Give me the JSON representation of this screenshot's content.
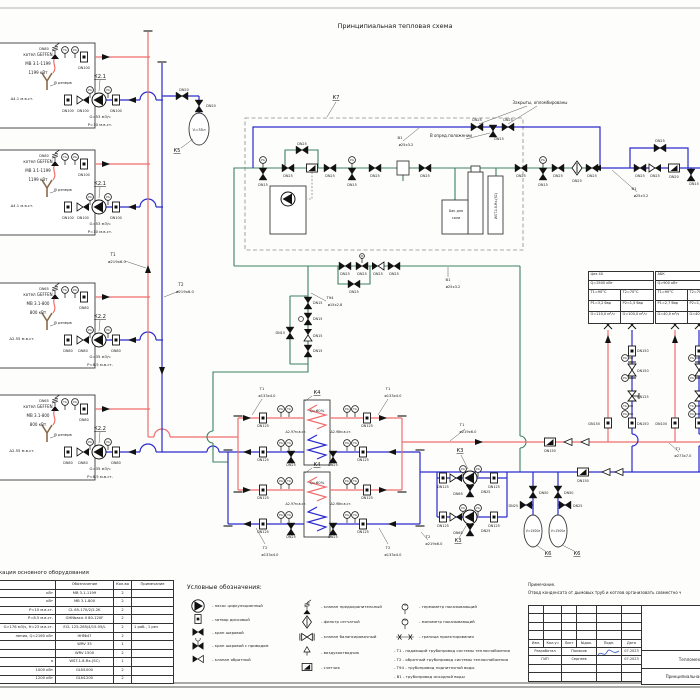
{
  "title": "Принципиальная тепловая схема",
  "colors": {
    "supply": "#ef6e6e",
    "return": "#2b2bcc",
    "raw_water": "#3c8162",
    "chimney": "#8a6a4a",
    "signature": "#3a55c0"
  },
  "gauges": {
    "tg": "TG",
    "pg": "PG"
  },
  "boilers": [
    {
      "y": 43,
      "name1": "котел GEFFEN",
      "name2": "МВ 3.1-1199",
      "name3": "1199 кВт",
      "delta": "Δ4.1 м.в.ст.",
      "reserve": "В резерв",
      "dn_safety": "DN80",
      "dn_supply": "DN100",
      "dn_return": "DN100",
      "pump": "К2.1",
      "flow": "G=53 м3/ч",
      "head": "P=10 м.в.ст."
    },
    {
      "y": 150,
      "name1": "котел GEFFEN",
      "name2": "МВ 3.1-1199",
      "name3": "1199 кВт",
      "delta": "Δ4.1 м.в.ст.",
      "reserve": "В резерв",
      "dn_safety": "DN80",
      "dn_supply": "DN100",
      "dn_return": "DN100",
      "pump": "К2.1",
      "flow": "G=53 м3/ч",
      "head": "P=10 м.в.ст."
    },
    {
      "y": 283,
      "name1": "котел GEFFEN",
      "name2": "МВ 3.1-800",
      "name3": "800 кВт",
      "delta": "Δ2.55 м.в.ст.",
      "reserve": "В резерв",
      "dn_safety": "DN65",
      "dn_supply": "DN80",
      "dn_return": "DN80",
      "pump": "К2.2",
      "flow": "G=35 м3/ч",
      "head": "P=8.5 м.в.ст."
    },
    {
      "y": 395,
      "name1": "котел GEFFEN",
      "name2": "МВ 3.1-800",
      "name3": "800 кВт",
      "delta": "Δ2.55 м.в.ст.",
      "reserve": "В резерв",
      "dn_safety": "DN65",
      "dn_supply": "DN80",
      "dn_return": "DN80",
      "pump": "К2.2",
      "flow": "G=35 м3/ч",
      "head": "P=8.5 м.в.ст."
    }
  ],
  "k4": [
    {
      "y": 400,
      "label": "К4",
      "q": "Q=60%",
      "dp_left": "Δ2.97м.в.ст.",
      "dp_right": "Δ2.98м.в.ст.",
      "dn_main": "DN125",
      "dn_drain": "DN25"
    },
    {
      "y": 472,
      "label": "К4",
      "q": "Q=60%",
      "dp_left": "Δ2.97м.в.ст.",
      "dp_right": "Δ2.98м.в.ст.",
      "dn_main": "DN125",
      "dn_drain": "DN25"
    }
  ],
  "consumers": [
    {
      "name": "Цех 40",
      "q": "Q=2500 кВт",
      "t1": "Т1=90°С",
      "t2": "Т2=70°С",
      "p1": "Р1=3,2 бар",
      "p2": "Р2=1,5 бар",
      "g1": "G=110,0 м³/ч",
      "g2": "G=100,0 м³/ч"
    },
    {
      "name": "АБК",
      "q": "Q=900 кВт",
      "t1": "Т1=90°С",
      "t2": "Т2=70°С",
      "p1": "Р1=2,7 бар",
      "p2": "Р2=1,5 бар",
      "g1": "G=40,0 м³/ч",
      "g2": "G=40,0 м³/ч"
    }
  ],
  "schematic": {
    "labels": [
      [
        113,
        256,
        "Т1",
        4
      ],
      [
        117,
        263,
        "ø219х6.0",
        3.8
      ],
      [
        181,
        286,
        "Т2",
        4
      ],
      [
        185,
        293,
        "ø219х6.0",
        3.8
      ],
      [
        184,
        91,
        "DN20",
        3.4
      ],
      [
        211,
        107,
        "DN20",
        3.4
      ],
      [
        199,
        131,
        "V=35л",
        3.8
      ],
      [
        177,
        152,
        "К5",
        5.2
      ],
      [
        336,
        99,
        "К7",
        5.2
      ],
      [
        263,
        161,
        "PG",
        2.7
      ],
      [
        263,
        186,
        "DN15",
        3.4
      ],
      [
        288,
        177,
        "DN25",
        3.4
      ],
      [
        302,
        145,
        "DN25",
        3.4
      ],
      [
        330,
        177,
        "DN25",
        3.4
      ],
      [
        352,
        161,
        "PG",
        2.7
      ],
      [
        352,
        186,
        "DN15",
        3.4
      ],
      [
        375,
        177,
        "DN25",
        3.4
      ],
      [
        425,
        177,
        "DN25",
        3.4
      ],
      [
        521,
        177,
        "DN25",
        3.4
      ],
      [
        543,
        161,
        "PG",
        2.7
      ],
      [
        543,
        186,
        "DN15",
        3.4
      ],
      [
        558,
        177,
        "DN25",
        3.4
      ],
      [
        577,
        182,
        "DN25",
        3.4
      ],
      [
        592,
        177,
        "DN25",
        3.4
      ],
      [
        456,
        212,
        "Бак для",
        3.4
      ],
      [
        456,
        219,
        "соли",
        3.4
      ],
      [
        497,
        206,
        "WST-1.8-Rx-(SC)",
        3.2,
        "middle",
        -90
      ],
      [
        477,
        121,
        "DN25",
        3.4
      ],
      [
        508,
        121,
        "DN25",
        3.4
      ],
      [
        499,
        140,
        "DN15",
        3.4
      ],
      [
        540,
        104,
        "Закрыты, опломбированы",
        4
      ],
      [
        451,
        137,
        "В опред.положении",
        4
      ],
      [
        400,
        139,
        "В1",
        3.8
      ],
      [
        406,
        146,
        "ø25х3.2",
        3.6
      ],
      [
        640,
        177,
        "DN25",
        3.4
      ],
      [
        655,
        177,
        "DN25",
        3.4
      ],
      [
        674,
        178,
        "DN20",
        3.4
      ],
      [
        694,
        185,
        "DN15",
        3.4
      ],
      [
        660,
        142,
        "DN25",
        3.4
      ],
      [
        634,
        190,
        "В1",
        3.8
      ],
      [
        641,
        197,
        "ø25х3.2",
        3.6
      ],
      [
        345,
        275,
        "DN25",
        3.4
      ],
      [
        362,
        275,
        "DN25",
        3.4
      ],
      [
        378,
        275,
        "DN25",
        3.4
      ],
      [
        394,
        275,
        "DN25",
        3.4
      ],
      [
        354,
        293,
        "DN25",
        3.4
      ],
      [
        448,
        281,
        "В1",
        3.8
      ],
      [
        453,
        288,
        "ø25х3.2",
        3.6
      ],
      [
        330,
        299,
        "Т94",
        3.8
      ],
      [
        335,
        306,
        "ø15х2.8",
        3.6
      ],
      [
        313,
        304,
        "DN15",
        3.4,
        "start"
      ],
      [
        313,
        320,
        "DN15",
        3.4,
        "start"
      ],
      [
        313,
        337,
        "DN15",
        3.4,
        "start"
      ],
      [
        313,
        352,
        "DN15",
        3.4,
        "start"
      ],
      [
        285,
        334,
        "DN15",
        3.4,
        "end"
      ],
      [
        262,
        390,
        "Т1",
        3.8
      ],
      [
        267,
        397,
        "ø133х4.0",
        3.6
      ],
      [
        388,
        390,
        "Т1",
        3.8
      ],
      [
        393,
        397,
        "ø133х4.0",
        3.6
      ],
      [
        265,
        549,
        "Т2",
        3.8
      ],
      [
        270,
        556,
        "ø133х4.0",
        3.6
      ],
      [
        388,
        549,
        "Т2",
        3.8
      ],
      [
        393,
        556,
        "ø133х4.0",
        3.6
      ],
      [
        428,
        538,
        "Т2",
        3.8
      ],
      [
        434,
        545,
        "ø219х6.0",
        3.6
      ],
      [
        462,
        426,
        "Т1",
        3.8
      ],
      [
        468,
        433,
        "ø219х6.0",
        3.6
      ],
      [
        678,
        450,
        "Т1",
        3.8
      ],
      [
        683,
        457,
        "ø273х7.0",
        3.6
      ],
      [
        550,
        452,
        "DN150",
        3.4
      ],
      [
        583,
        482,
        "DN150",
        3.4
      ],
      [
        460,
        452,
        "К3",
        5.2
      ],
      [
        458,
        542,
        "К3",
        5.2
      ],
      [
        443,
        488,
        "DN125",
        3.4
      ],
      [
        458,
        495,
        "DN65",
        3.4
      ],
      [
        494,
        488,
        "DN125",
        3.4
      ],
      [
        481,
        493,
        "DN25",
        3.4,
        "start"
      ],
      [
        443,
        527,
        "DN125",
        3.4
      ],
      [
        458,
        534,
        "DN65",
        3.4
      ],
      [
        494,
        527,
        "DN125",
        3.4
      ],
      [
        481,
        532,
        "DN25",
        3.4,
        "start"
      ],
      [
        463,
        470,
        "PG",
        2.7
      ],
      [
        478,
        470,
        "PG",
        2.7
      ],
      [
        463,
        509,
        "PG",
        2.7
      ],
      [
        478,
        509,
        "PG",
        2.7
      ],
      [
        539,
        494,
        "DN50",
        3.4,
        "start"
      ],
      [
        564,
        494,
        "DN50",
        3.4,
        "start"
      ],
      [
        518,
        507,
        "DN25",
        3.4,
        "end"
      ],
      [
        573,
        507,
        "DN25",
        3.4,
        "start"
      ],
      [
        533,
        532,
        "V=1500л",
        3.1
      ],
      [
        558,
        532,
        "V=1500л",
        3.1
      ],
      [
        548,
        555,
        "К6",
        5.2
      ],
      [
        577,
        555,
        "К6",
        5.2
      ],
      [
        637,
        352,
        "DN150",
        3.4,
        "start"
      ],
      [
        637,
        372,
        "DN150",
        3.4,
        "start"
      ],
      [
        637,
        398,
        "DN125",
        3.4,
        "start"
      ],
      [
        637,
        425,
        "DN150",
        3.4,
        "start"
      ],
      [
        600,
        425,
        "DN150",
        3.4,
        "end"
      ],
      [
        667,
        425,
        "DN100",
        3.4,
        "end"
      ],
      [
        625,
        359,
        "PG",
        2.7
      ],
      [
        625,
        379,
        "PG",
        2.7
      ],
      [
        625,
        407,
        "TG",
        2.7
      ],
      [
        625,
        415,
        "PG",
        2.7
      ],
      [
        692,
        359,
        "PG",
        2.7
      ],
      [
        692,
        379,
        "PG",
        2.7
      ],
      [
        692,
        407,
        "TG",
        2.7
      ],
      [
        692,
        415,
        "PG",
        2.7
      ]
    ]
  },
  "spec_table": {
    "caption": "Спецификация основного оборудования",
    "headers": [
      "",
      "Обозначение",
      "Кол-во",
      "Примечание"
    ],
    "rows": [
      [
        "кВт",
        "МВ 3.1-1199",
        "2",
        ""
      ],
      [
        "кВт",
        "МВ 3.1-800",
        "2",
        ""
      ],
      [
        "P=10 м.в.ст.",
        "CL 65-170/2/2.2K",
        "2",
        ""
      ],
      [
        "P=8.5 м.в.ст.",
        "GHNbasic II 80-120F",
        "2",
        ""
      ],
      [
        "G=176 м3/ч, Н=23 м.в.ст.",
        "ECL 125-285/4/15.05/L",
        "2",
        "1 раб., 1 рез"
      ],
      [
        "ления, Q=2160 кВт",
        "НН№47",
        "2",
        ""
      ],
      [
        "",
        "WRV 35",
        "1",
        ""
      ],
      [
        "",
        "WRV 1500",
        "2",
        ""
      ],
      [
        "я",
        "WST-1.8-Rx-(SC)",
        "1",
        ""
      ],
      [
        "1000 кВт",
        "GLN1000",
        "2",
        ""
      ],
      [
        "1200 кВт",
        "GLN1200",
        "2",
        ""
      ]
    ]
  },
  "legend": {
    "heading": "Условные обозначения:",
    "col1": [
      {
        "sym": "pump",
        "flip": true,
        "label": "- насос циркуляционный"
      },
      {
        "sym": "gate",
        "label": "- затвор дисковый"
      },
      {
        "sym": "ball",
        "label": "- кран шаровой"
      },
      {
        "sym": "ballact",
        "label": "- кран шаровой с приводом"
      },
      {
        "sym": "check",
        "label": "- клапан обратный"
      }
    ],
    "col2": [
      {
        "sym": "safety",
        "label": "- клапан предохранительный"
      },
      {
        "sym": "strainer",
        "label": "- фильтр сетчатый"
      },
      {
        "sym": "balance",
        "label": "- клапан балансировочный"
      },
      {
        "sym": "airvent",
        "label": "- воздухоотводчик"
      },
      {
        "sym": "meter",
        "label": "- счетчик"
      }
    ],
    "col3": [
      {
        "sym": "gauge",
        "glyph": "TG",
        "label": "- термометр показывающий"
      },
      {
        "sym": "gauge",
        "glyph": "PG",
        "label": "- манометр показывающий"
      },
      {
        "sym": "bound",
        "label": "- граница проектирования"
      }
    ],
    "pipes": [
      "- Т1 - подающий трубопровод системы теплоснабжения",
      "- Т2 - обратный трубопровод системы теплоснабжения",
      "- Т94 - трубопровод подпиточной воды",
      "- В1 - трубопровод исходной воды"
    ]
  },
  "note": {
    "heading": "Примечание.",
    "text": "Отвод конденсата от дымовых труб и котлов организовать совместно ч"
  },
  "titleblock": {
    "headers": [
      "Изм.",
      "Кол.уч",
      "Лист",
      "№док.",
      "Подп.",
      "Дата"
    ],
    "rows": [
      [
        "Разработал",
        "Поляков",
        "07.2023"
      ],
      [
        "ГИП",
        "Сергеев",
        "07.2023"
      ]
    ],
    "doc1": "Тепломеханические",
    "doc2": "Принципиальная тепловая схема"
  }
}
